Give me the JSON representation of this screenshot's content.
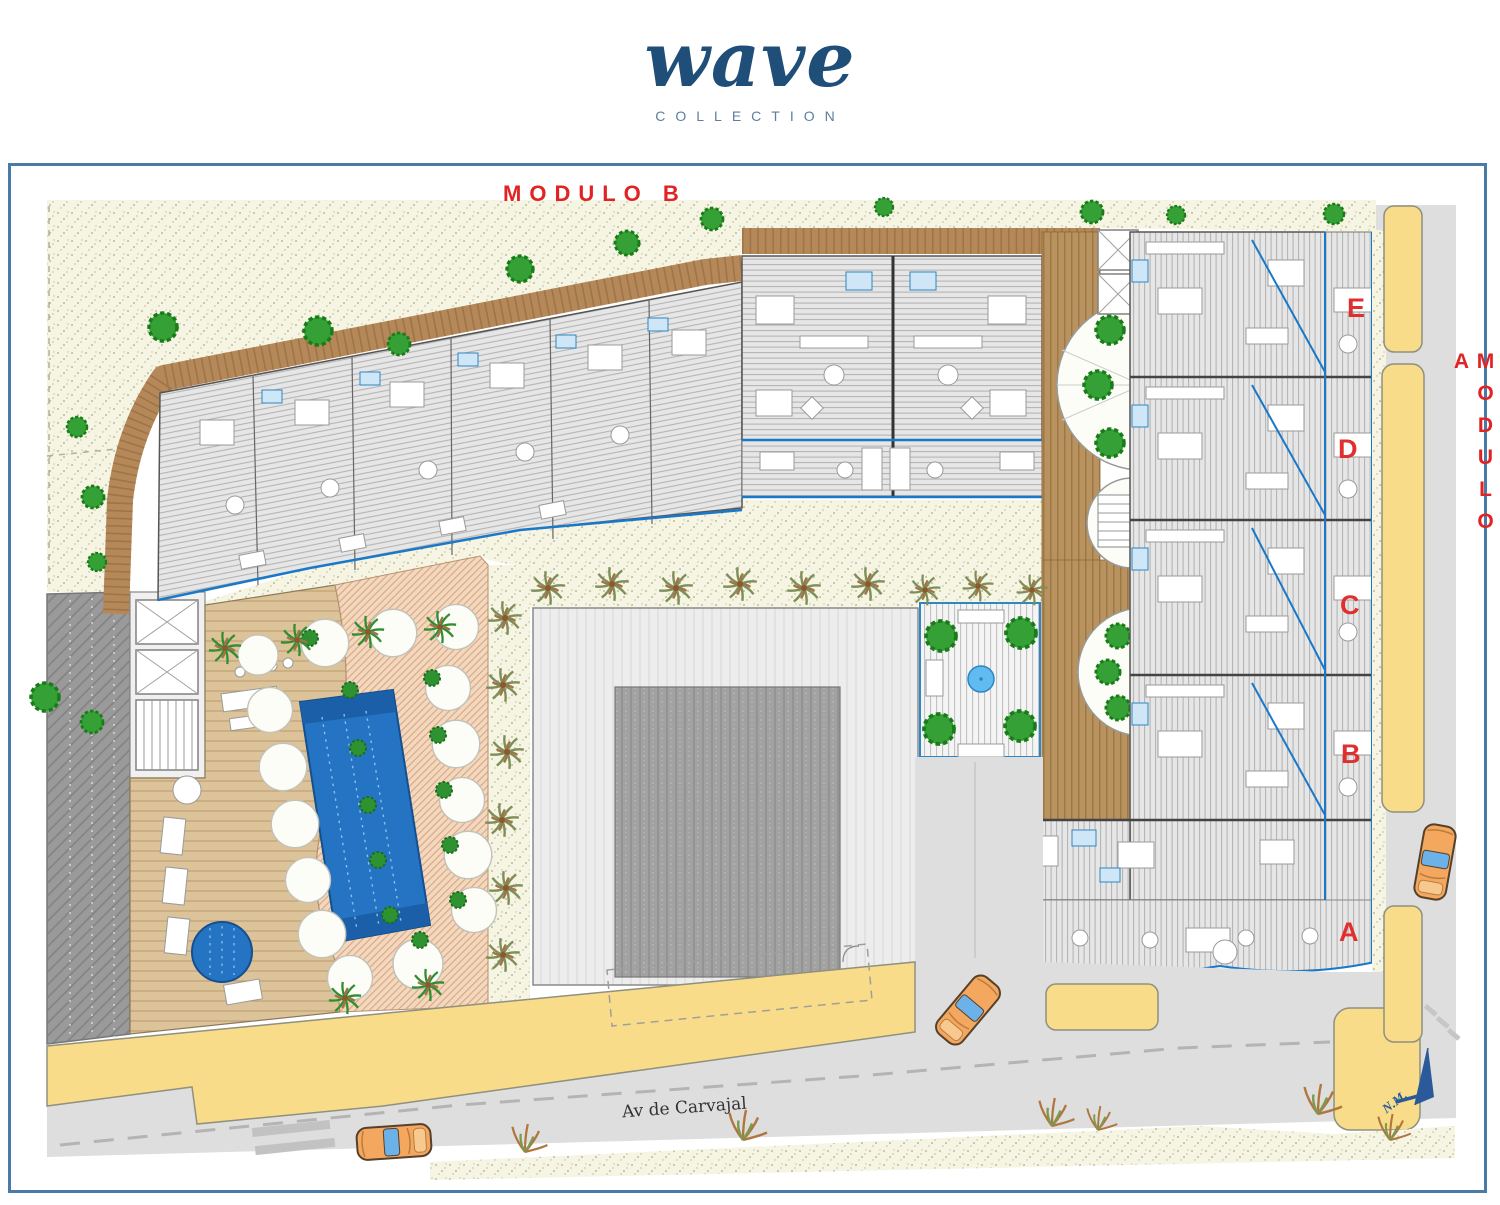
{
  "logo": {
    "brand": "wave",
    "tagline": "COLLECTION"
  },
  "plan": {
    "module_b_label": "MODULO B",
    "module_a_label": "MODULO A",
    "street_name": "Av de Carvajal",
    "north_marker": "N.M.",
    "module_a_units": [
      {
        "letter": "E"
      },
      {
        "letter": "D"
      },
      {
        "letter": "C"
      },
      {
        "letter": "B"
      },
      {
        "letter": "A"
      }
    ]
  },
  "colors": {
    "brand_blue": "#1f4e79",
    "tagline_blue": "#5e7e9e",
    "label_red": "#e02424",
    "frame_blue": "#4a7aa8",
    "pool_blue": "#2574c4",
    "fountain_blue": "#62bbf0",
    "glass_blue": "#1a78c8",
    "sidewalk_yellow": "#f8dc8a",
    "road_gray": "#dedede",
    "sand_cream": "#f6f4e2",
    "deck_brown": "#b5885a",
    "terracotta": "#f2d8bc",
    "tree_green": "#35a035",
    "car_orange": "#f4a75e"
  }
}
